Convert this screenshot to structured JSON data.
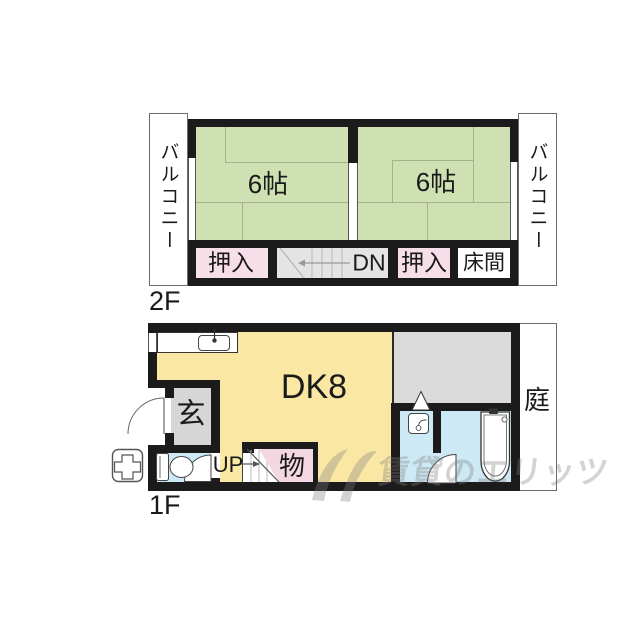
{
  "f2": {
    "floor_label": "2F",
    "balcony_left": "バルコニー",
    "balcony_right": "バルコニー",
    "room_left": "6帖",
    "room_right": "6帖",
    "closet_left": "押入",
    "closet_right": "押入",
    "stairs_down": "DN",
    "tokonoma": "床間"
  },
  "f1": {
    "floor_label": "1F",
    "dining_kitchen": "DK8",
    "entrance": "玄",
    "stairs_up": "UP",
    "storage": "物",
    "garden": "庭"
  },
  "watermark": {
    "text": "賃貸のエリッツ"
  },
  "colors": {
    "tatami_green": "#cfe0b2",
    "closet_pink": "#f6dfe9",
    "storage_pink": "#f3d7e3",
    "dk_yellow": "#fbe7a4",
    "entry_gray": "#d6d6d6",
    "utility_gray": "#dadada",
    "water_blue": "#cde9f5",
    "stair_gray": "#e4e4e4",
    "wall_black": "#1b1b1b"
  }
}
